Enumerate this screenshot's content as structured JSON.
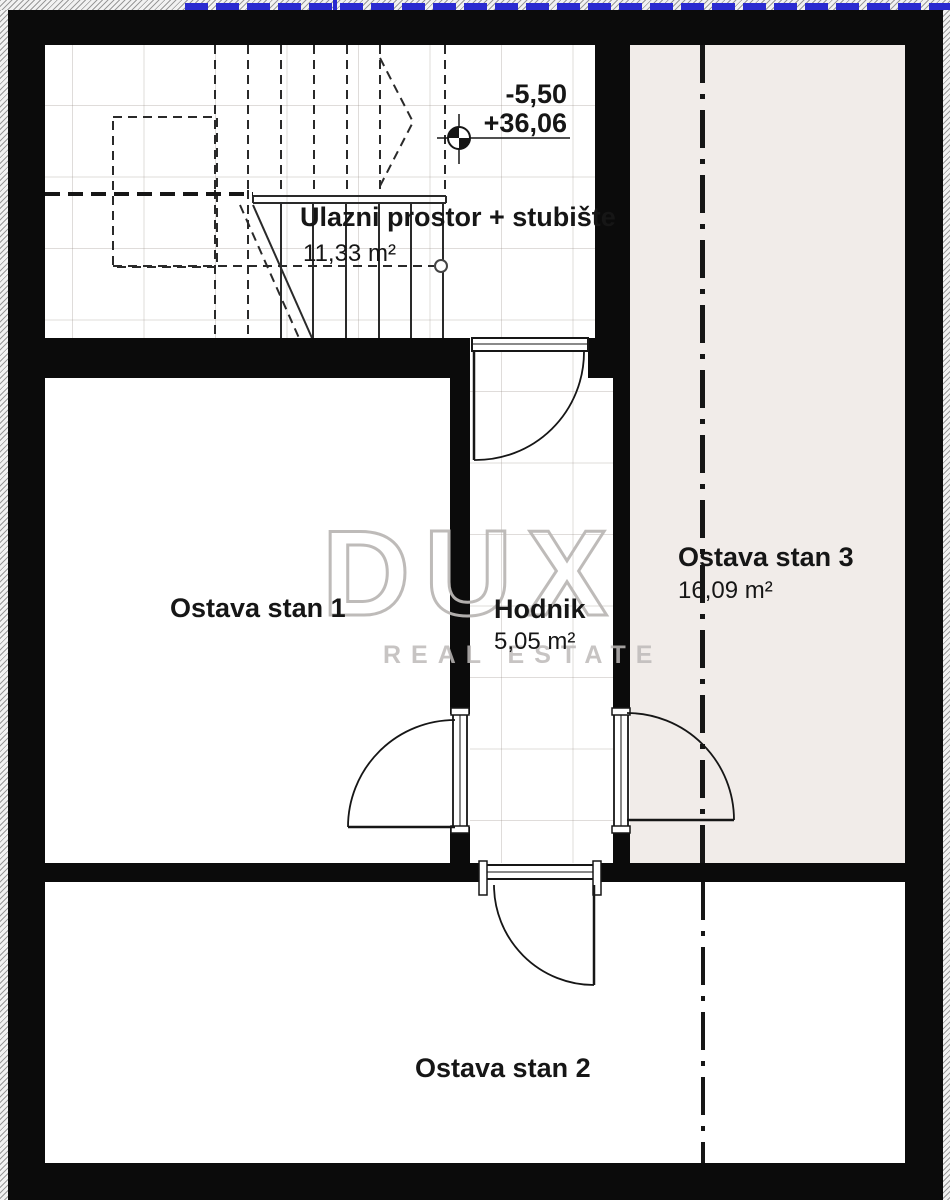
{
  "plan": {
    "rooms": [
      {
        "id": "ulazni",
        "name": "Ulazni prostor + stubište",
        "area": "11,33 m²"
      },
      {
        "id": "ostava1",
        "name": "Ostava stan 1"
      },
      {
        "id": "hodnik",
        "name": "Hodnik",
        "area": "5,05 m²"
      },
      {
        "id": "ostava3",
        "name": "Ostava stan 3",
        "area": "16,09 m²"
      },
      {
        "id": "ostava2",
        "name": "Ostava stan 2"
      }
    ],
    "level_marker": {
      "relative_level": "-5,50",
      "absolute_level": "+36,06"
    },
    "colors": {
      "wall": "#0b0b0b",
      "stan3_floor": "#f1ece9",
      "boundary_blue": "#2a2ad0",
      "grid": "rgba(150,140,133,0.30)"
    }
  },
  "watermark": {
    "brand": "DUX",
    "tagline": "REAL ESTATE"
  }
}
